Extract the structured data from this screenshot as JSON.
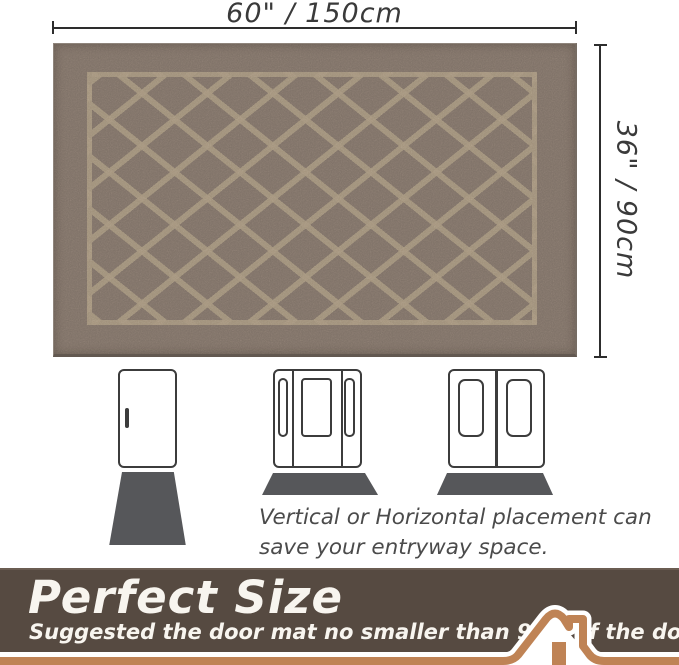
{
  "product": {
    "type": "door-mat-size-infographic",
    "mat_pattern": "diamond-lattice",
    "colors": {
      "mat_base": "#7d7066",
      "mat_pattern": "#a4947c",
      "banner_brown": "#564a41",
      "accent_tan": "#bf8355",
      "diagram_gray": "#3c3c3c",
      "floor_mat_gray": "#56575a"
    }
  },
  "dimensions": {
    "width_label": "60\" / 150cm",
    "height_label": "36\" / 90cm"
  },
  "placement": {
    "note_line1": "Vertical or Horizontal placement can",
    "note_line2": "save your entryway space.",
    "door_types": [
      "single-door",
      "door-with-sidelights",
      "double-door"
    ]
  },
  "banner": {
    "title": "Perfect Size",
    "subtitle": "Suggested the door mat no smaller than 90% of the door width."
  },
  "icons": {
    "house": "house-roof-icon"
  }
}
